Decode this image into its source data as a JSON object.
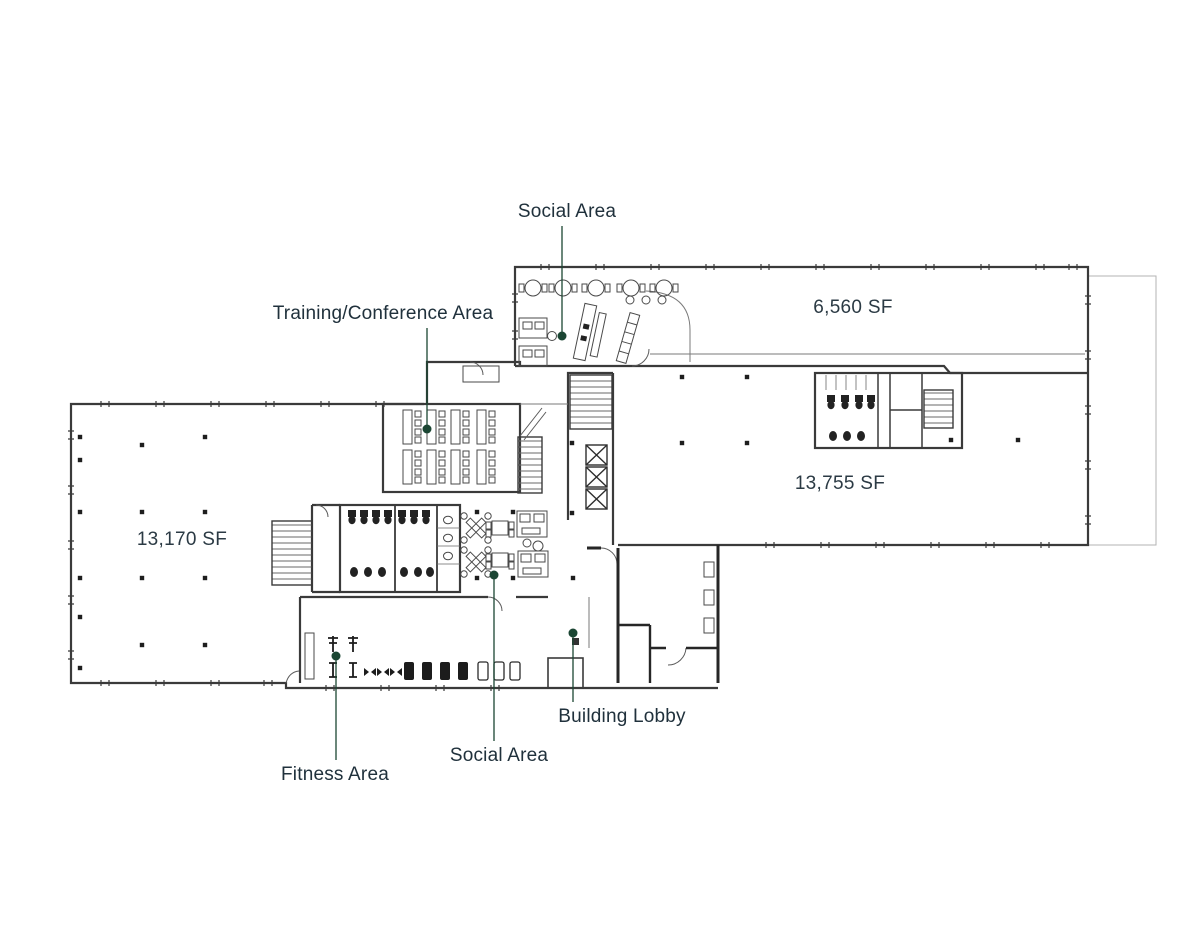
{
  "colors": {
    "leader_line": "#1b4633",
    "leader_dot": "#1b4633",
    "label_text": "#20313c",
    "wall_line": "#3a3a3a",
    "background": "#ffffff"
  },
  "labels": {
    "social_top": "Social Area",
    "training": "Training/Conference Area",
    "lobby": "Building Lobby",
    "social_bottom": "Social Area",
    "fitness": "Fitness Area"
  },
  "area_sizes": {
    "right_top": "6,560 SF",
    "right_main": "13,755 SF",
    "left": "13,170 SF"
  }
}
